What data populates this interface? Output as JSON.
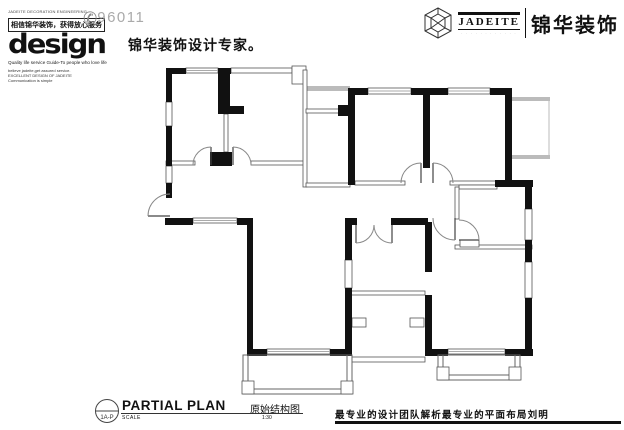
{
  "header": {
    "left": {
      "micro_line": "JADEITE DECORATION ENGINEERING",
      "boxed_slogan": "相信锦华装饰，获得放心服务",
      "logo_text": "design",
      "phone_icon": "phone-icon",
      "phone_number": "96011",
      "tagline": "Quality life service Guide-To people who love life",
      "sub_line_1": "believe jadeite,get assured service.",
      "sub_line_2": "EXCELLENT DESIGN OF JADEITE",
      "sub_line_3": "Communication is simple",
      "brand_slogan_cn": "锦华装饰设计专家。"
    },
    "right": {
      "logo_en": "JADEITE",
      "logo_sub": "· · · · · · · · · · · ·",
      "brand_cn": "锦华装饰"
    }
  },
  "footer": {
    "drawing_tag": "1A-P",
    "title_en": "PARTIAL PLAN",
    "title_cn": "原始结构图",
    "scale_label": "SCALE",
    "scale_value": "1:30",
    "note_cn": "最专业的设计团队解析最专业的平面布局刘明"
  },
  "plan": {
    "type": "original-structure-floor-plan",
    "colors": {
      "wall": "#111111",
      "thin_wall": "#555555",
      "window_mid": "#aaaaaa",
      "ledge": "#bbbbbb"
    }
  }
}
